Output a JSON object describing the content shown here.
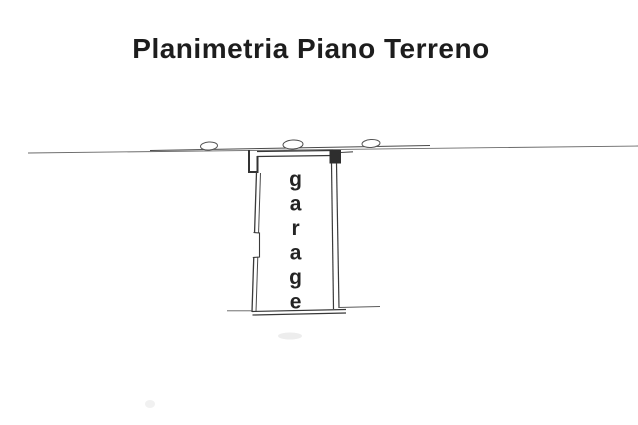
{
  "title": "Planimetria Piano Terreno",
  "plan": {
    "room_label": "garage"
  },
  "colors": {
    "ink": "#1d1d1d",
    "wall_line": "#3a3a3a",
    "site_line": "#6a6a6a",
    "background": "#ffffff"
  }
}
